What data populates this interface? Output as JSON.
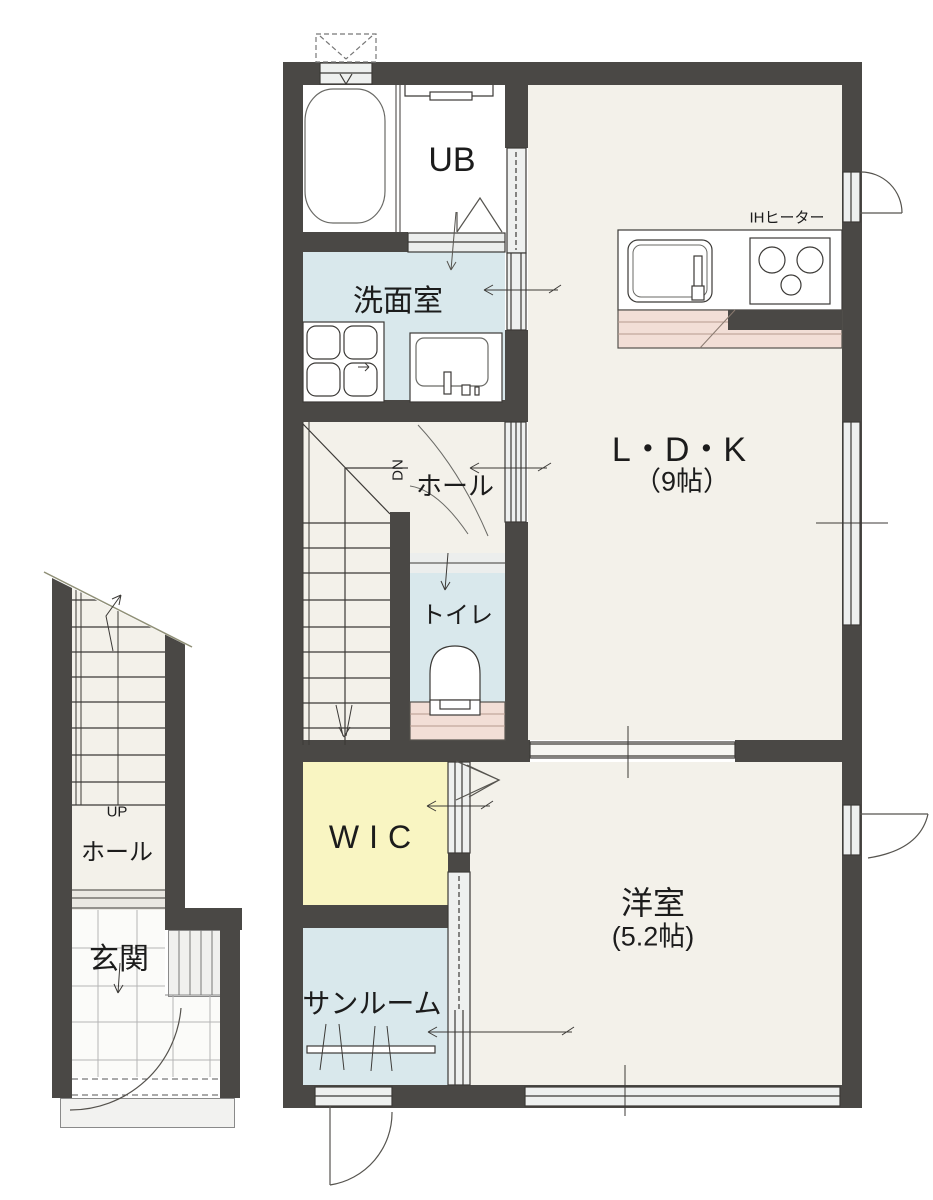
{
  "plan_title": "1F floor plan",
  "rooms": {
    "ub": {
      "label": "UB"
    },
    "senmenshitsu": {
      "label": "洗面室"
    },
    "ldk": {
      "label": "L・D・K",
      "size": "（9帖）"
    },
    "hall_main": {
      "label": "ホール"
    },
    "toilet": {
      "label": "トイレ"
    },
    "wic": {
      "label": "WIC"
    },
    "western_room": {
      "label": "洋室",
      "size": "(5.2帖)"
    },
    "sunroom": {
      "label": "サンルーム"
    },
    "entry_hall": {
      "label": "ホール"
    },
    "genkan": {
      "label": "玄関"
    }
  },
  "labels": {
    "ih_heater": "IHヒーター",
    "stairs_down": "DN",
    "stairs_up": "UP"
  },
  "colors": {
    "wall": "#4a4845",
    "floor_cream": "#f3f1ea",
    "wet_blue": "#d9e8ec",
    "wic_yellow": "#f9f5c2",
    "counter_pink": "#f2ded6",
    "opening_gray": "#eef0ef",
    "tile_white": "#fbfbf9",
    "line": "#3c3a37"
  }
}
